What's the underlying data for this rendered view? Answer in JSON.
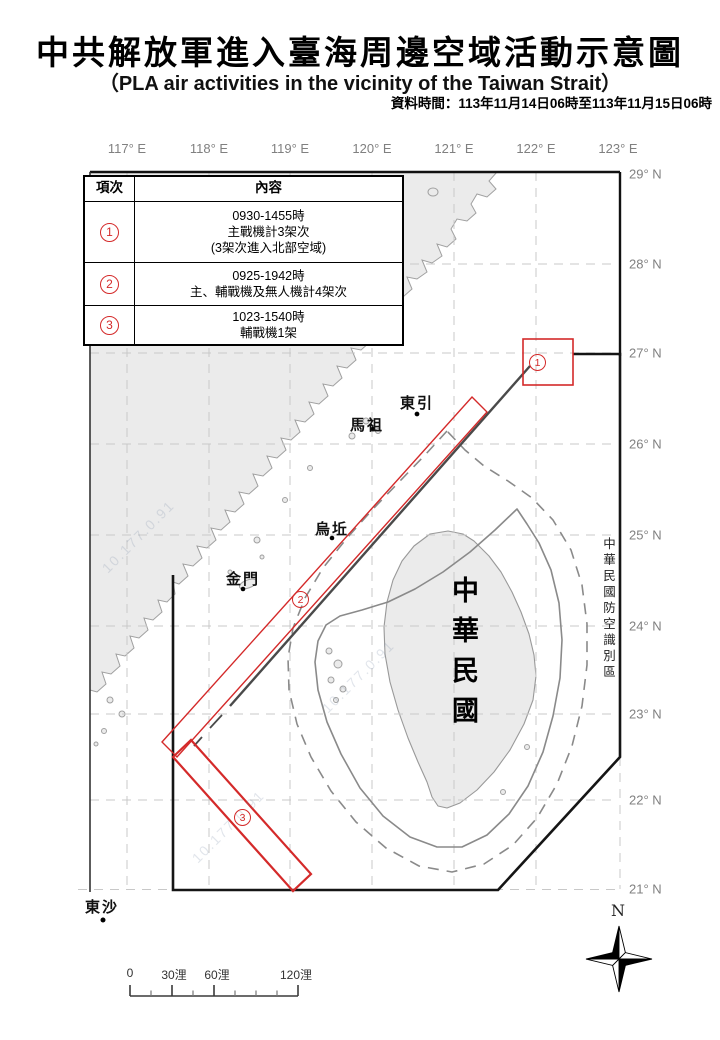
{
  "header": {
    "title": "中共解放軍進入臺海周邊空域活動示意圖",
    "subtitle": "（PLA air activities in the vicinity of the Taiwan Strait）",
    "data_time": "資料時間：113年11月14日06時至113年11月15日06時"
  },
  "table": {
    "headers": {
      "item": "項次",
      "content": "內容"
    },
    "rows": [
      {
        "digit": "1",
        "line1": "0930-1455時",
        "line2": "主戰機計3架次",
        "line3": "(3架次進入北部空域)"
      },
      {
        "digit": "2",
        "line1": "0925-1942時",
        "line2": "主、輔戰機及無人機計4架次",
        "line3": ""
      },
      {
        "digit": "3",
        "line1": "1023-1540時",
        "line2": "輔戰機1架",
        "line3": ""
      }
    ]
  },
  "axes": {
    "lon": [
      "117° E",
      "118° E",
      "119° E",
      "120° E",
      "121° E",
      "122° E",
      "123° E"
    ],
    "lat": [
      "29° N",
      "28° N",
      "27° N",
      "26° N",
      "25° N",
      "24° N",
      "23° N",
      "22° N",
      "21° N"
    ]
  },
  "map": {
    "places": {
      "dongyin": "東引",
      "matsu": "馬祖",
      "wuqiu": "烏坵",
      "kinmen": "金門",
      "pratas": "東沙"
    },
    "taiwan_label": "中華民國",
    "adiz_label": "中華民國防空識別區",
    "markers": {
      "m1": "1",
      "m2": "2",
      "m3": "3"
    },
    "compass": "N",
    "watermark": "10.177.0.91"
  },
  "scalebar": {
    "l0": "0",
    "l30": "30浬",
    "l60": "60浬",
    "l120": "120浬"
  },
  "colors": {
    "red": "#d42a2a",
    "land_fill": "#ebebeb",
    "land_stroke": "#a0a0a0",
    "grid": "#c8c8c8",
    "contour": "#8a8a8a",
    "median": "#4a4a4a",
    "adiz": "#151515",
    "axis_text": "#808080"
  }
}
